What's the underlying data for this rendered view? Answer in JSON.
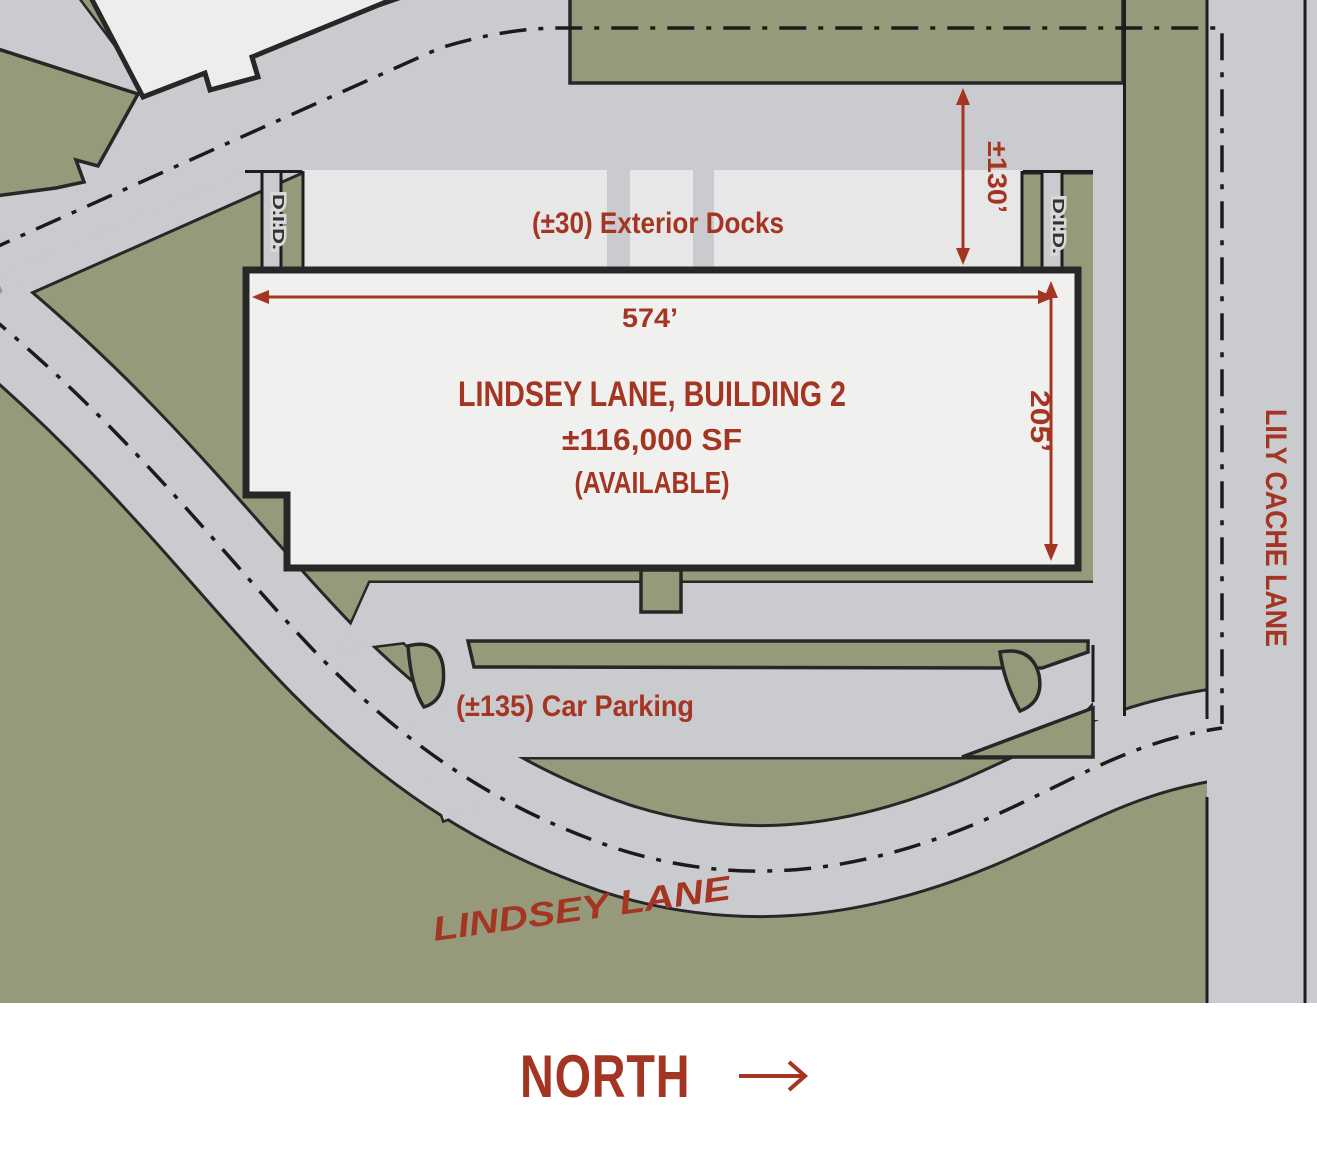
{
  "building": {
    "name": "LINDSEY LANE, BUILDING 2",
    "area": "±116,000 SF",
    "status": "(AVAILABLE)"
  },
  "docks_label": "(±30) Exterior Docks",
  "parking_label": "(±135) Car Parking",
  "dimensions": {
    "building_length": "574’",
    "building_depth": "205’",
    "truck_court_depth": "±130’"
  },
  "roads": {
    "lindsey": "LINDSEY LANE",
    "lily_cache": "LILY CACHE LANE"
  },
  "doors": {
    "left": "D.I.D.",
    "right": "D.I.D."
  },
  "north_label": "NORTH",
  "colors": {
    "grass": "#979a7a",
    "road": "#c9cbce",
    "apron": "#e7e7e7",
    "building_fill": "#f0f0ef",
    "neighbor_fill": "#ededec",
    "outline": "#272727",
    "accent": "#a43522"
  }
}
